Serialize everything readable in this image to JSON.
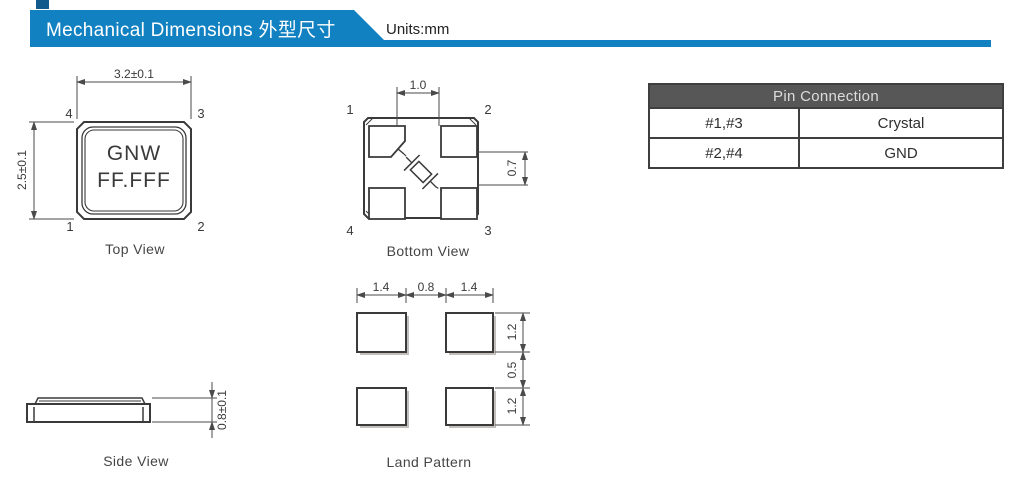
{
  "header": {
    "title": "Mechanical Dimensions 外型尺寸",
    "units_label": "Units:mm"
  },
  "colors": {
    "banner_blue": "#1181c2",
    "banner_notch_blue": "#135a8c",
    "table_header_bg": "#575757",
    "table_header_text": "#dcdcdc",
    "table_border": "#3f3f3f",
    "drawing_line": "#3a3a3a",
    "dimension_line": "#4a4a4a"
  },
  "top_view": {
    "caption": "Top View",
    "marking_line1": "GNW",
    "marking_line2": "FF.FFF",
    "dim_width": "3.2±0.1",
    "dim_height": "2.5±0.1",
    "pin_top_left": "4",
    "pin_top_right": "3",
    "pin_bottom_left": "1",
    "pin_bottom_right": "2"
  },
  "bottom_view": {
    "caption": "Bottom View",
    "dim_pad_gap_horizontal": "1.0",
    "dim_pad_gap_vertical": "0.7",
    "pin_top_left": "1",
    "pin_top_right": "2",
    "pin_bottom_left": "4",
    "pin_bottom_right": "3"
  },
  "side_view": {
    "caption": "Side View",
    "dim_height": "0.8±0.1"
  },
  "land_pattern": {
    "caption": "Land Pattern",
    "dims_top": [
      "1.4",
      "0.8",
      "1.4"
    ],
    "dims_right": [
      "1.2",
      "0.5",
      "1.2"
    ]
  },
  "pin_table": {
    "title": "Pin Connection",
    "rows": [
      {
        "pins": "#1,#3",
        "connection": "Crystal"
      },
      {
        "pins": "#2,#4",
        "connection": "GND"
      }
    ]
  }
}
